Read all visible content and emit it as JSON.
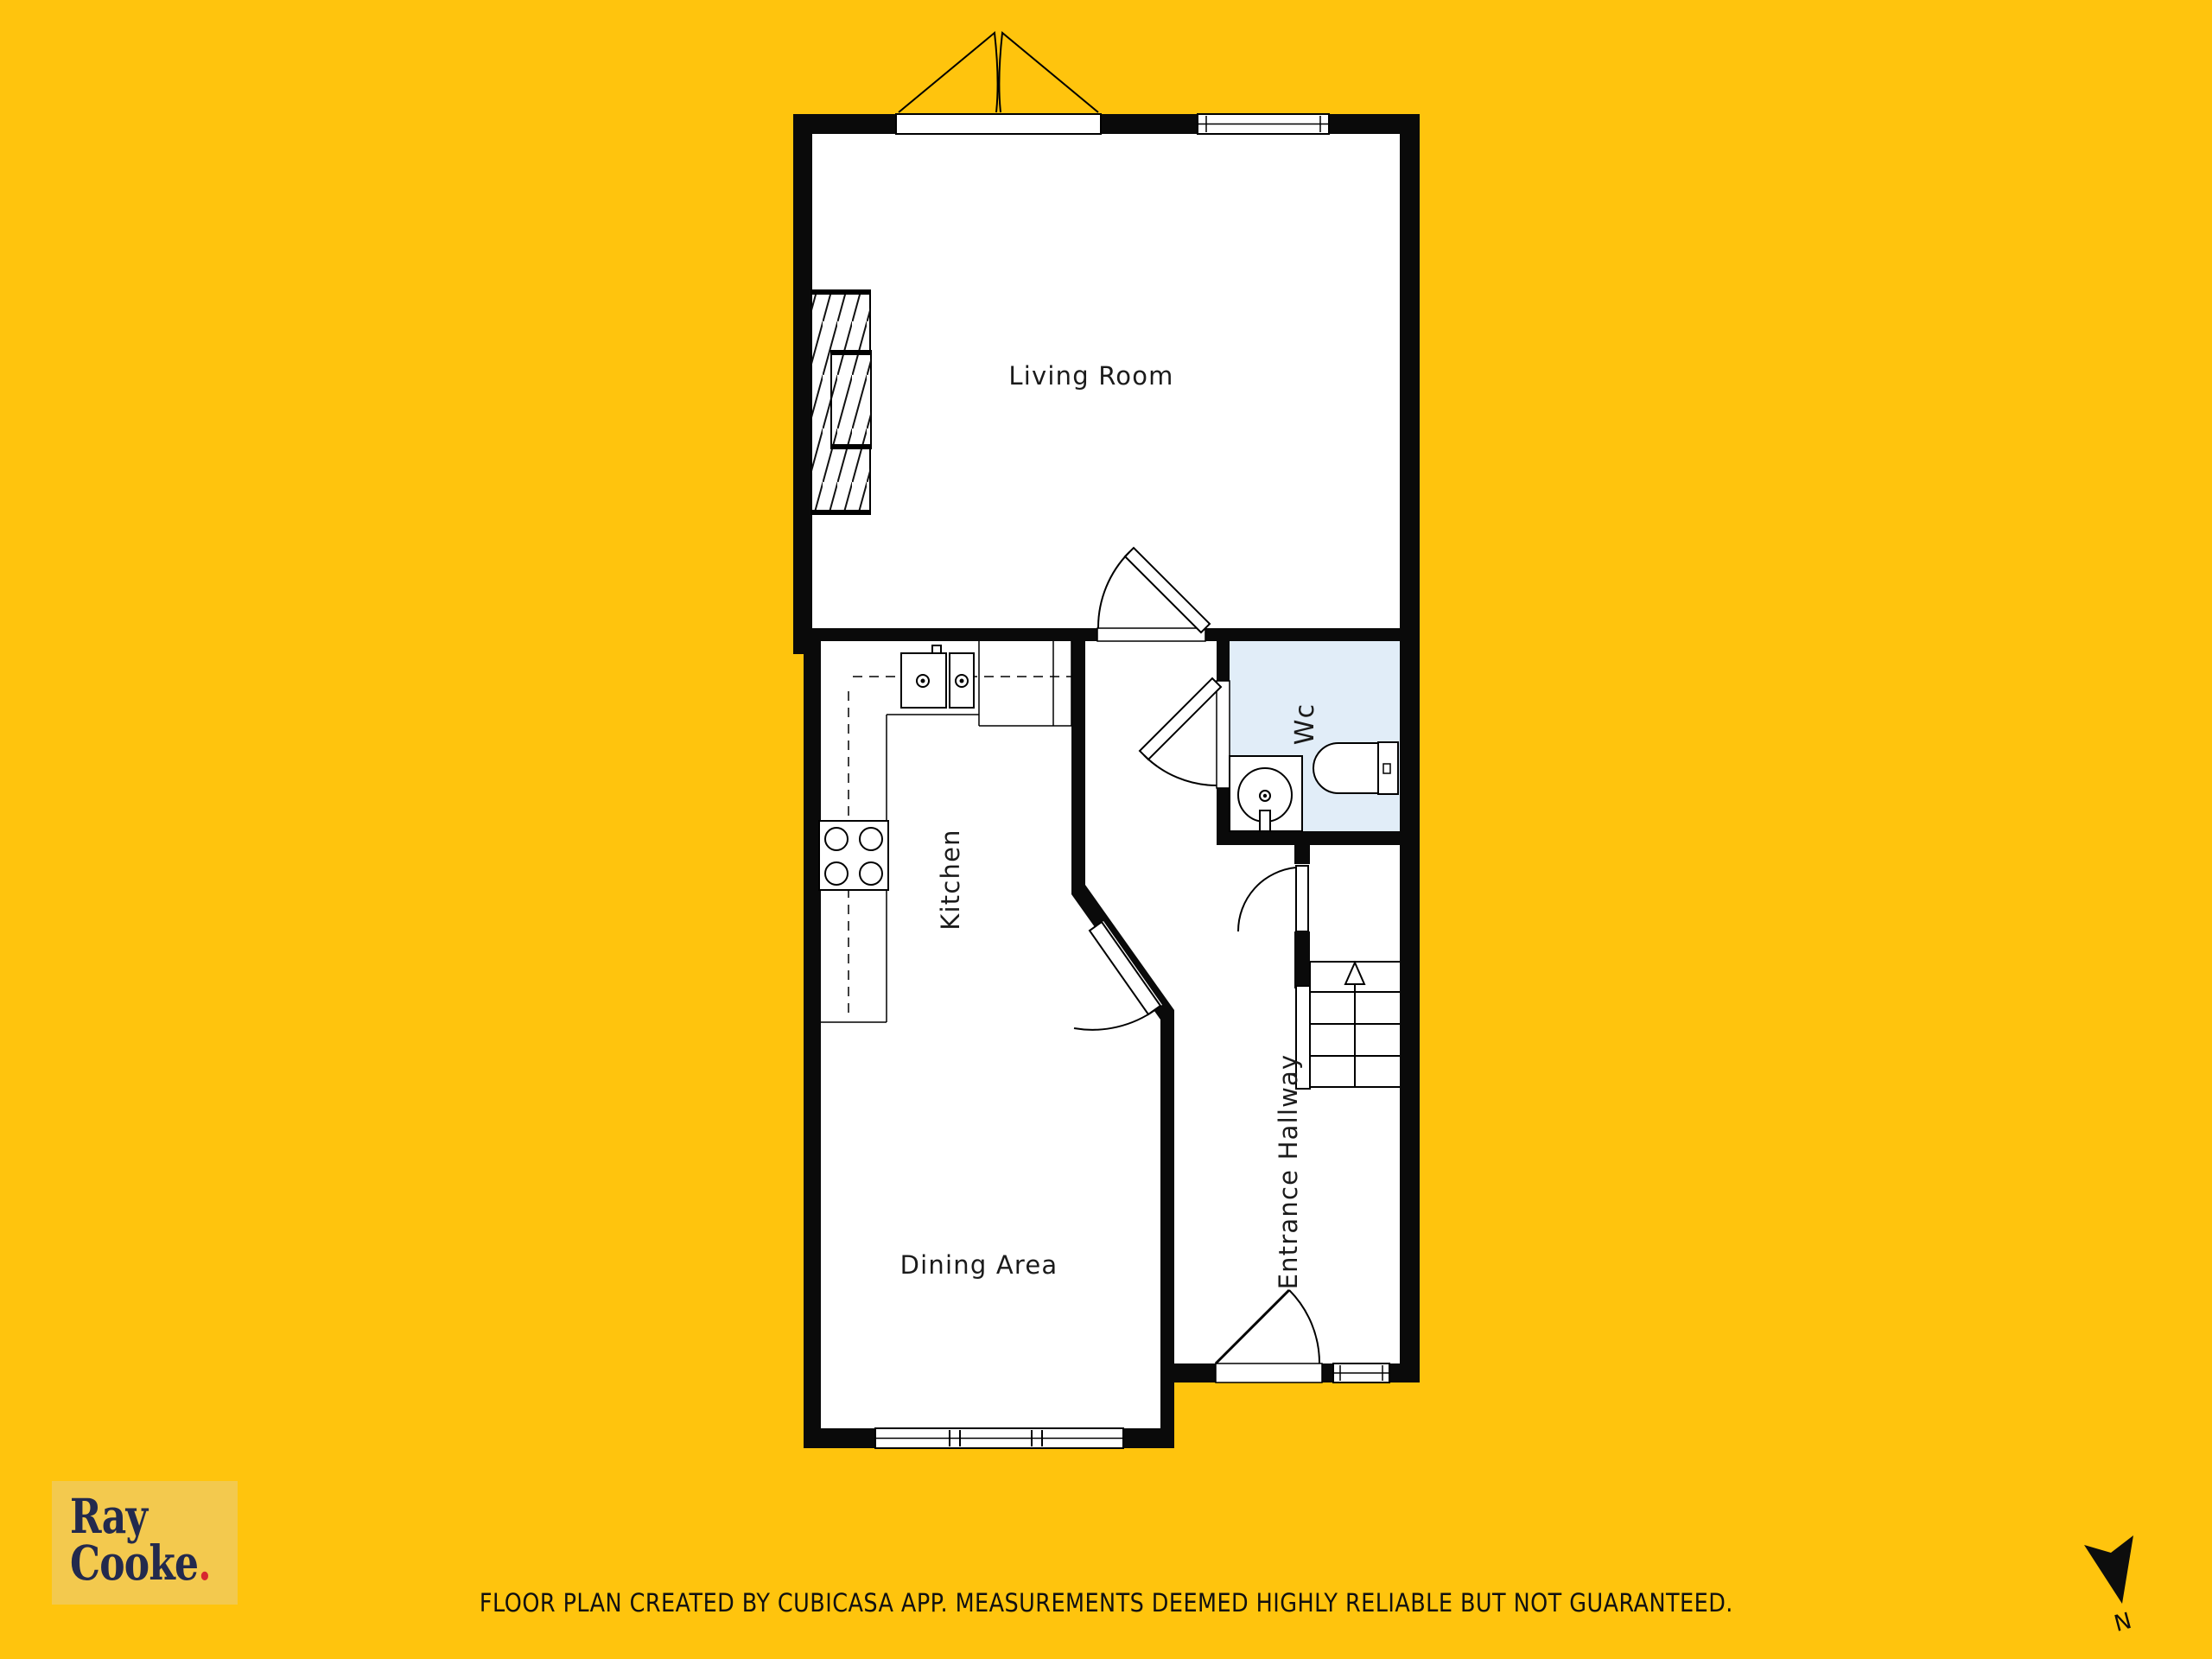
{
  "page": {
    "background_color": "#FFC40D"
  },
  "floor_plan": {
    "rooms": [
      {
        "label": "Living Room"
      },
      {
        "label": "Kitchen"
      },
      {
        "label": "Dining Area"
      },
      {
        "label": "Entrance Hallway"
      },
      {
        "label": "Wc"
      }
    ],
    "colors": {
      "wall": "#0A0A0A",
      "floor": "#FFFFFF",
      "wc_floor": "#E1EDF8",
      "line": "#000000"
    }
  },
  "branding": {
    "line1": "Ray",
    "line2": "Cooke",
    "period": ".",
    "colors": {
      "panel": "#F3C94E",
      "text": "#232A4D",
      "accent": "#D7282F"
    }
  },
  "footer": {
    "disclaimer": "FLOOR PLAN CREATED BY CUBICASA APP. MEASUREMENTS DEEMED HIGHLY RELIABLE BUT NOT GUARANTEED."
  },
  "compass": {
    "label": "N"
  }
}
